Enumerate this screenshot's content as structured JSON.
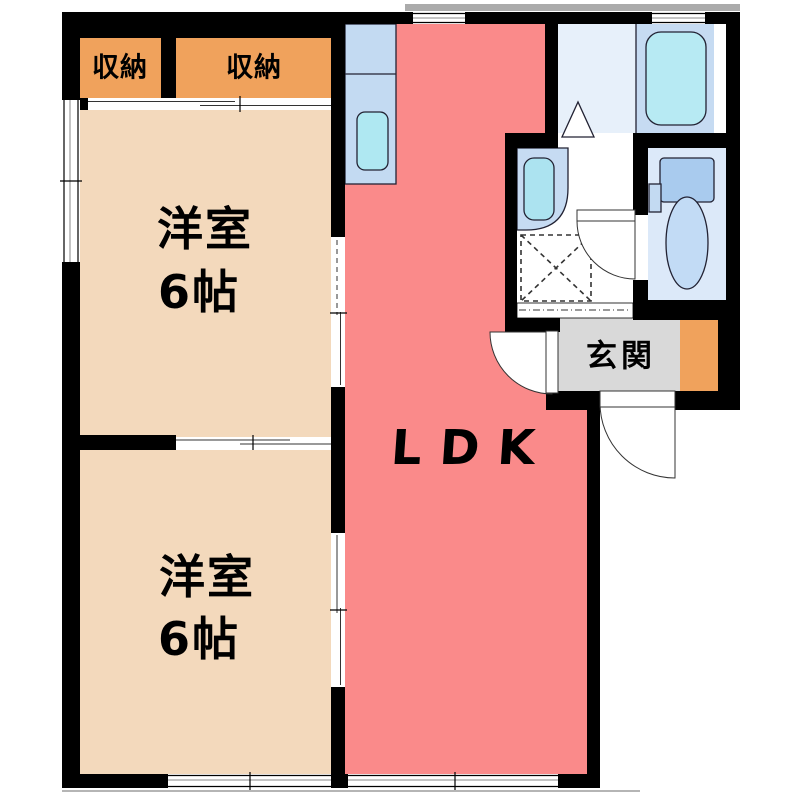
{
  "rooms": {
    "closet_left": {
      "label": "収納"
    },
    "closet_right": {
      "label": "収納"
    },
    "bedroom_top": {
      "label": "洋室",
      "size": "6帖"
    },
    "bedroom_bottom": {
      "label": "洋室",
      "size": "6帖"
    },
    "ldk": {
      "label": "LDK"
    },
    "entrance": {
      "label": "玄関"
    }
  },
  "fixtures": {
    "kitchen_counter": "kitchen-counter-with-sink",
    "bathtub": "bathtub",
    "wash_basin": "wash-basin",
    "washing_machine_pan": "washing-machine-pan-dashed",
    "toilet": "toilet-with-tank",
    "doors": "swing-door-arcs-and-sliding-doors"
  },
  "colors": {
    "wall": "#000000",
    "closet": "#F0A25C",
    "bedroom": "#F3D9BC",
    "ldk": "#FA8A8A",
    "genkan": "#D9D9D9",
    "counter": "#C3DAF2",
    "sink": "#AFE8F2",
    "bath_floor": "#C6DBF2",
    "bath_anteroom": "#E7F0FA",
    "bathtub": "#B7EAF3",
    "washroom_floor": "#FFFFFF",
    "toilet_floor": "#DCE9F9",
    "toilet_tank": "#A9CBEE",
    "toilet_bowl": "#C2DBF5",
    "basin_outer": "#C6DBF2",
    "basin_inner": "#ACE3F0",
    "eave": "#ABABAB",
    "outline": "#222222"
  }
}
